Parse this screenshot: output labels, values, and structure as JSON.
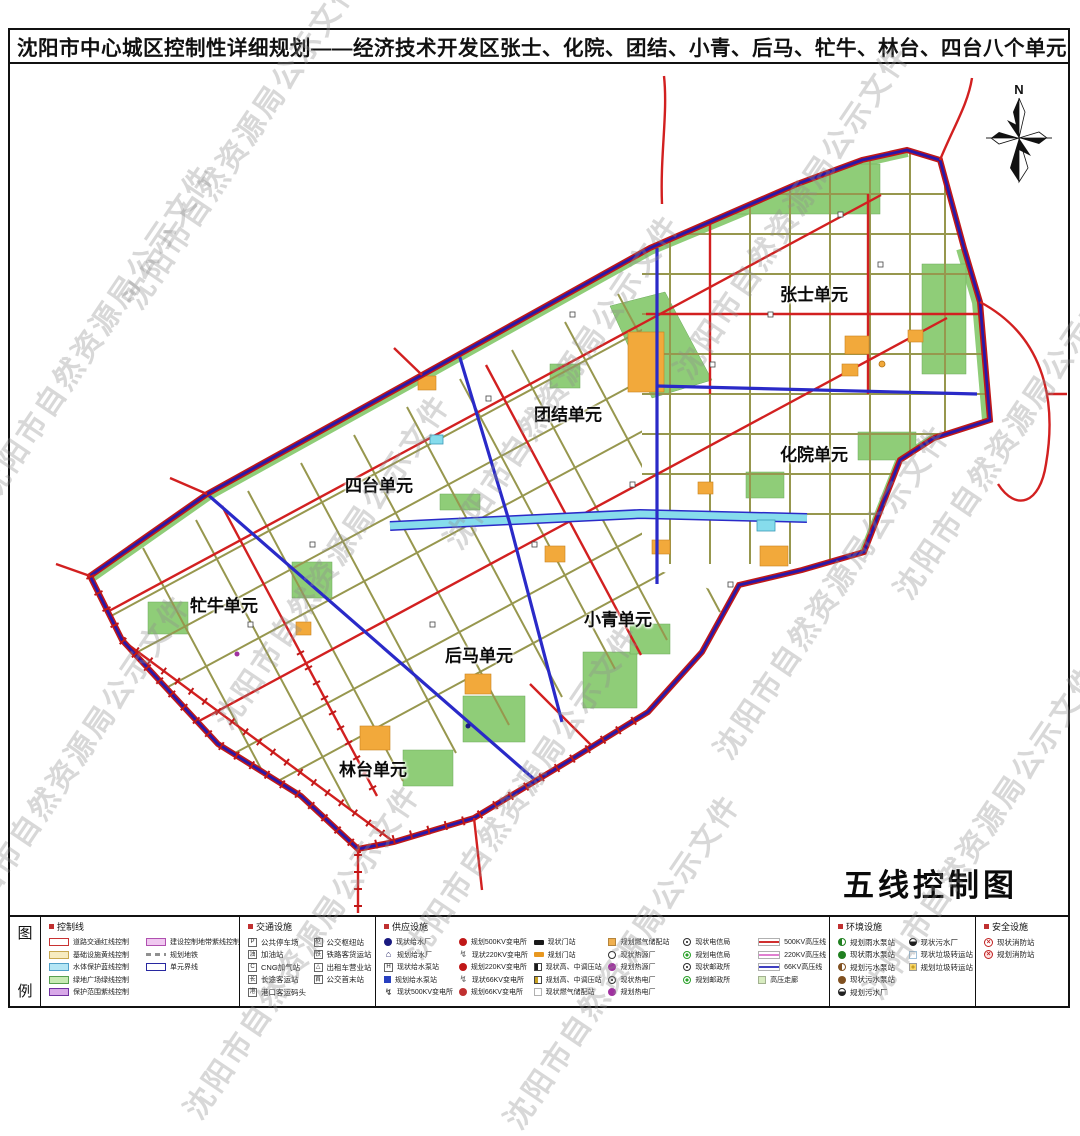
{
  "page": {
    "title": "沈阳市中心城区控制性详细规划——经济技术开发区张士、化院、团结、小青、后马、牤牛、林台、四台八个单元"
  },
  "watermark": {
    "text": "沈阳市自然资源局公示文件"
  },
  "map": {
    "north_label": "N",
    "title": "五线控制图",
    "colors": {
      "boundary_red": "#c01818",
      "unit_boundary_blue": "#2a18a8",
      "road_khaki": "#97974e",
      "road_red": "#d22020",
      "green_space": "#8fcd78",
      "parcel_orange": "#f2a93b",
      "water_cyan": "#86dcec"
    },
    "units": [
      {
        "name": "张士单元",
        "x": 812,
        "y": 291
      },
      {
        "name": "团结单元",
        "x": 566,
        "y": 411
      },
      {
        "name": "化院单元",
        "x": 812,
        "y": 451
      },
      {
        "name": "四台单元",
        "x": 377,
        "y": 482
      },
      {
        "name": "牤牛单元",
        "x": 222,
        "y": 602
      },
      {
        "name": "小青单元",
        "x": 616,
        "y": 616
      },
      {
        "name": "后马单元",
        "x": 477,
        "y": 652
      },
      {
        "name": "林台单元",
        "x": 371,
        "y": 766
      }
    ]
  },
  "legend": {
    "label_chars": [
      "图",
      "例"
    ],
    "sections": [
      {
        "title": "控制线",
        "columns": [
          [
            {
              "swatch": {
                "type": "openrect",
                "color": "#c83232",
                "fill": "#ffffff"
              },
              "label": "道路交通红线控制"
            },
            {
              "swatch": {
                "type": "openrect",
                "color": "#c8a850",
                "fill": "#f7ecc0"
              },
              "label": "基础设施黄线控制"
            },
            {
              "swatch": {
                "type": "openrect",
                "color": "#50a0c8",
                "fill": "#b4e6f5"
              },
              "label": "水体保护蓝线控制"
            },
            {
              "swatch": {
                "type": "openrect",
                "color": "#58a050",
                "fill": "#c8eab4"
              },
              "label": "绿地广场绿线控制"
            },
            {
              "swatch": {
                "type": "openrect",
                "color": "#7030a0",
                "fill": "#d8a8e8"
              },
              "label": "保护范围紫线控制"
            }
          ],
          [
            {
              "swatch": {
                "type": "openrect",
                "color": "#b050b0",
                "fill": "#f0c8f0"
              },
              "label": "建设控制地带紫线控制"
            },
            {
              "swatch": {
                "type": "dashes",
                "color": "#909090"
              },
              "label": "规划地铁"
            },
            {
              "swatch": {
                "type": "openrect",
                "color": "#2828a0",
                "fill": "#ffffff"
              },
              "label": "单元界线"
            }
          ]
        ]
      },
      {
        "title": "交通设施",
        "columns": [
          [
            {
              "swatch": {
                "type": "sq",
                "glyph": "P",
                "color": "#333333"
              },
              "label": "公共停车场"
            },
            {
              "swatch": {
                "type": "sq",
                "glyph": "油",
                "color": "#333333"
              },
              "label": "加油站"
            },
            {
              "swatch": {
                "type": "sq",
                "glyph": "C",
                "color": "#333333"
              },
              "label": "CNG加气站"
            },
            {
              "swatch": {
                "type": "sq",
                "glyph": "长",
                "color": "#333333"
              },
              "label": "长途客运站"
            },
            {
              "swatch": {
                "type": "sq",
                "glyph": "港",
                "color": "#333333"
              },
              "label": "港口客运码头"
            }
          ],
          [
            {
              "swatch": {
                "type": "sq",
                "glyph": "枢",
                "color": "#333333"
              },
              "label": "公交枢纽站"
            },
            {
              "swatch": {
                "type": "sq",
                "glyph": "铁",
                "color": "#333333"
              },
              "label": "铁路客货运站"
            },
            {
              "swatch": {
                "type": "sq",
                "glyph": "△",
                "color": "#333333"
              },
              "label": "出租车营业站"
            },
            {
              "swatch": {
                "type": "sq",
                "glyph": "首",
                "color": "#333333"
              },
              "label": "公交首末站"
            }
          ]
        ]
      },
      {
        "title": "供应设施",
        "columns": [
          [
            {
              "swatch": {
                "type": "circle",
                "color": "#1a1a80"
              },
              "label": "现状给水厂"
            },
            {
              "swatch": {
                "type": "house",
                "color": "#1a1a60"
              },
              "label": "规划给水厂"
            },
            {
              "swatch": {
                "type": "sq",
                "glyph": "H",
                "color": "#222222"
              },
              "label": "现状给水泵站"
            },
            {
              "swatch": {
                "type": "square",
                "color": "#2840c0"
              },
              "label": "规划给水泵站"
            },
            {
              "swatch": {
                "type": "bolt",
                "color": "#505050"
              },
              "label": "现状500KV变电所"
            }
          ],
          [
            {
              "swatch": {
                "type": "circle",
                "color": "#c01818"
              },
              "label": "规划500KV变电所"
            },
            {
              "swatch": {
                "type": "bolt",
                "color": "#808080"
              },
              "label": "现状220KV变电所"
            },
            {
              "swatch": {
                "type": "circle",
                "color": "#c01818"
              },
              "label": "规划220KV变电所"
            },
            {
              "swatch": {
                "type": "bolt",
                "color": "#808080"
              },
              "label": "现状66KV变电所"
            },
            {
              "swatch": {
                "type": "circle",
                "color": "#c03030"
              },
              "label": "规划66KV变电所"
            }
          ],
          [
            {
              "swatch": {
                "type": "bar",
                "color": "#1a1a1a"
              },
              "label": "现状门站"
            },
            {
              "swatch": {
                "type": "bar",
                "color": "#e89820"
              },
              "label": "规划门站"
            },
            {
              "swatch": {
                "type": "halfbar",
                "color": "#1a1a1a"
              },
              "label": "现状高、中调压站"
            },
            {
              "swatch": {
                "type": "halfbar",
                "color": "#c8a020"
              },
              "label": "规划高、中调压站"
            },
            {
              "swatch": {
                "type": "sqoutline",
                "color": "#b0b0b0"
              },
              "label": "现状燃气储配站"
            }
          ],
          [
            {
              "swatch": {
                "type": "sqfill",
                "color": "#f0b050"
              },
              "label": "规划燃气储配站"
            },
            {
              "swatch": {
                "type": "ring",
                "color": "#303030"
              },
              "label": "现状热源厂"
            },
            {
              "swatch": {
                "type": "circle",
                "color": "#a030a0"
              },
              "label": "规划热源厂"
            },
            {
              "swatch": {
                "type": "clock",
                "color": "#303030"
              },
              "label": "现状热电厂"
            },
            {
              "swatch": {
                "type": "circle",
                "color": "#a030a0"
              },
              "label": "规划热电厂"
            }
          ],
          [
            {
              "swatch": {
                "type": "clock",
                "color": "#303030"
              },
              "label": "现状电信局"
            },
            {
              "swatch": {
                "type": "ringfill",
                "color": "#28a028"
              },
              "label": "规划电信局"
            },
            {
              "swatch": {
                "type": "clock",
                "color": "#303030"
              },
              "label": "现状邮政所"
            },
            {
              "swatch": {
                "type": "ringfill",
                "color": "#28a028"
              },
              "label": "规划邮政所"
            }
          ],
          [
            {
              "swatch": {
                "type": "line",
                "color": "#d03030"
              },
              "label": "500KV高压线"
            },
            {
              "swatch": {
                "type": "line",
                "color": "#e080d0"
              },
              "label": "220KV高压线"
            },
            {
              "swatch": {
                "type": "line",
                "color": "#4040c0"
              },
              "label": "66KV高压线"
            },
            {
              "swatch": {
                "type": "sqfill",
                "color": "#d8ecc0"
              },
              "label": "高压走廊"
            }
          ]
        ]
      },
      {
        "title": "环境设施",
        "columns": [
          [
            {
              "swatch": {
                "type": "half",
                "color": "#208020"
              },
              "label": "规划雨水泵站"
            },
            {
              "swatch": {
                "type": "circle",
                "color": "#208020"
              },
              "label": "现状雨水泵站"
            },
            {
              "swatch": {
                "type": "half",
                "color": "#805020"
              },
              "label": "规划污水泵站"
            },
            {
              "swatch": {
                "type": "circle",
                "color": "#805020"
              },
              "label": "现状污水泵站"
            },
            {
              "swatch": {
                "type": "pot",
                "color": "#202020"
              },
              "label": "规划污水厂"
            }
          ],
          [
            {
              "swatch": {
                "type": "pot",
                "color": "#202020"
              },
              "label": "现状污水厂"
            },
            {
              "swatch": {
                "type": "sqoutline",
                "color": "#a0c0d8"
              },
              "label": "现状垃圾转运站"
            },
            {
              "swatch": {
                "type": "sunsq",
                "color": "#c8a020"
              },
              "label": "规划垃圾转运站"
            }
          ]
        ]
      },
      {
        "title": "安全设施",
        "columns": [
          [
            {
              "swatch": {
                "type": "fire",
                "color": "#c02020"
              },
              "label": "现状消防站"
            },
            {
              "swatch": {
                "type": "fire2",
                "color": "#c02020"
              },
              "label": "规划消防站"
            }
          ]
        ]
      }
    ]
  }
}
